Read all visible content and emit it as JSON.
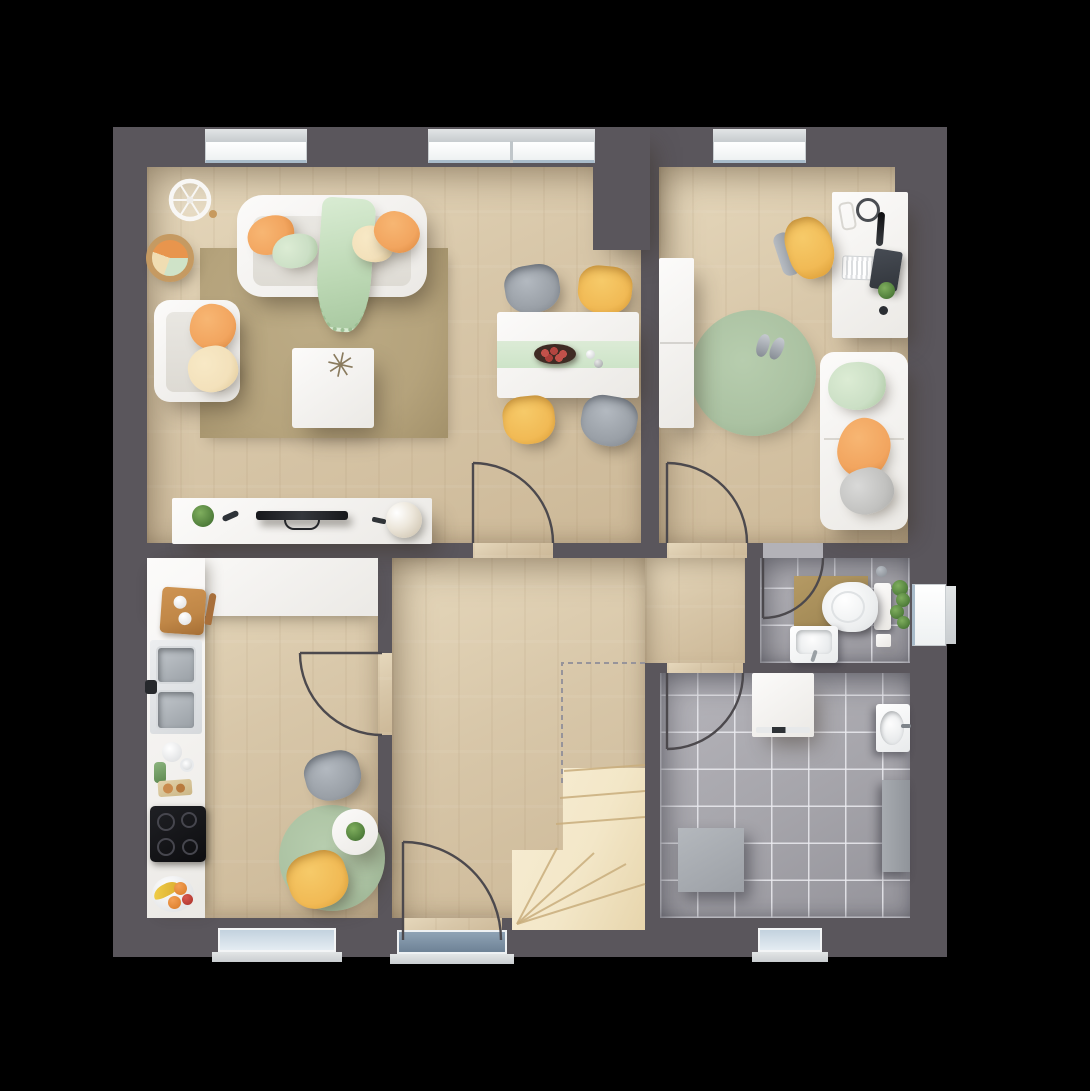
{
  "scene": {
    "type": "floor-plan",
    "view": "top-down-render",
    "background": "#000000"
  },
  "palette": {
    "wall": "#5a565c",
    "floorWood": "#d8c7a9",
    "floorWoodLight": "#e6d8bc",
    "tile": "#a5a4aa",
    "stairs": "#f3e7c8",
    "stairLine": "#c9ae7d",
    "sofaWhite": "#eceae5",
    "accentOrange": "#f2a55f",
    "accentYellow": "#f1ba55",
    "accentGreen": "#cbdfc5",
    "accentCream": "#f3e1bb",
    "sage": "#abc2a2",
    "tanRug": "#b5a37c",
    "bathMat": "#a58c58",
    "doorStroke": "#4c494d",
    "dash": "#97949a",
    "glass": "#c3d2de",
    "dark": "#1d1d22",
    "gray": "#9aa0a7",
    "woodAccent": "#c08747"
  },
  "rooms": [
    {
      "id": "living-room",
      "name": "Living Room",
      "furniture": [
        "sofa",
        "throw-blanket",
        "pillows-orange-green-cream",
        "armchair",
        "coffee-table",
        "area-rug",
        "basket-side-table",
        "wheel-decor",
        "tv-sideboard",
        "tv",
        "flower-bouquet"
      ]
    },
    {
      "id": "dining-area",
      "name": "Dining Area",
      "furniture": [
        "dining-table",
        "table-runner",
        "fruit-bowl",
        "chair-gray-nw",
        "chair-yellow-ne",
        "chair-yellow-sw",
        "chair-gray-se"
      ]
    },
    {
      "id": "office",
      "name": "Office / Guest Room",
      "furniture": [
        "wardrobe",
        "desk",
        "office-chair",
        "laptop",
        "keyboard",
        "headphones",
        "smartphone",
        "desk-lamp",
        "round-rug",
        "slippers",
        "daybed"
      ]
    },
    {
      "id": "kitchen",
      "name": "Kitchen",
      "furniture": [
        "l-shaped-counter",
        "double-sink",
        "cooktop",
        "cutting-board",
        "coffee-set",
        "fruit-plate",
        "bistro-table",
        "potted-plant",
        "chair-gray",
        "chair-yellow",
        "round-rug"
      ]
    },
    {
      "id": "bathroom",
      "name": "WC",
      "furniture": [
        "toilet",
        "washbasin",
        "bath-mat",
        "hanging-plant"
      ]
    },
    {
      "id": "utility-room",
      "name": "Utility Room",
      "furniture": [
        "washing-machine",
        "utility-sink",
        "wall-cabinet",
        "storage-box"
      ]
    },
    {
      "id": "hallway",
      "name": "Hallway",
      "furniture": [
        "winder-staircase",
        "entry-threshold"
      ]
    }
  ],
  "openings": {
    "windows": [
      "living-room-north",
      "dining-north-double",
      "office-north",
      "bathroom-east",
      "kitchen-south",
      "utility-south"
    ],
    "doors": [
      "entry-door-south",
      "dining-room-door",
      "office-door",
      "kitchen-door",
      "bathroom-door",
      "utility-door"
    ],
    "stairs": {
      "type": "winder",
      "shape": "L-turn",
      "opening_outline": "dashed"
    }
  },
  "icons": {
    "coffee-table-plant": "✳"
  }
}
